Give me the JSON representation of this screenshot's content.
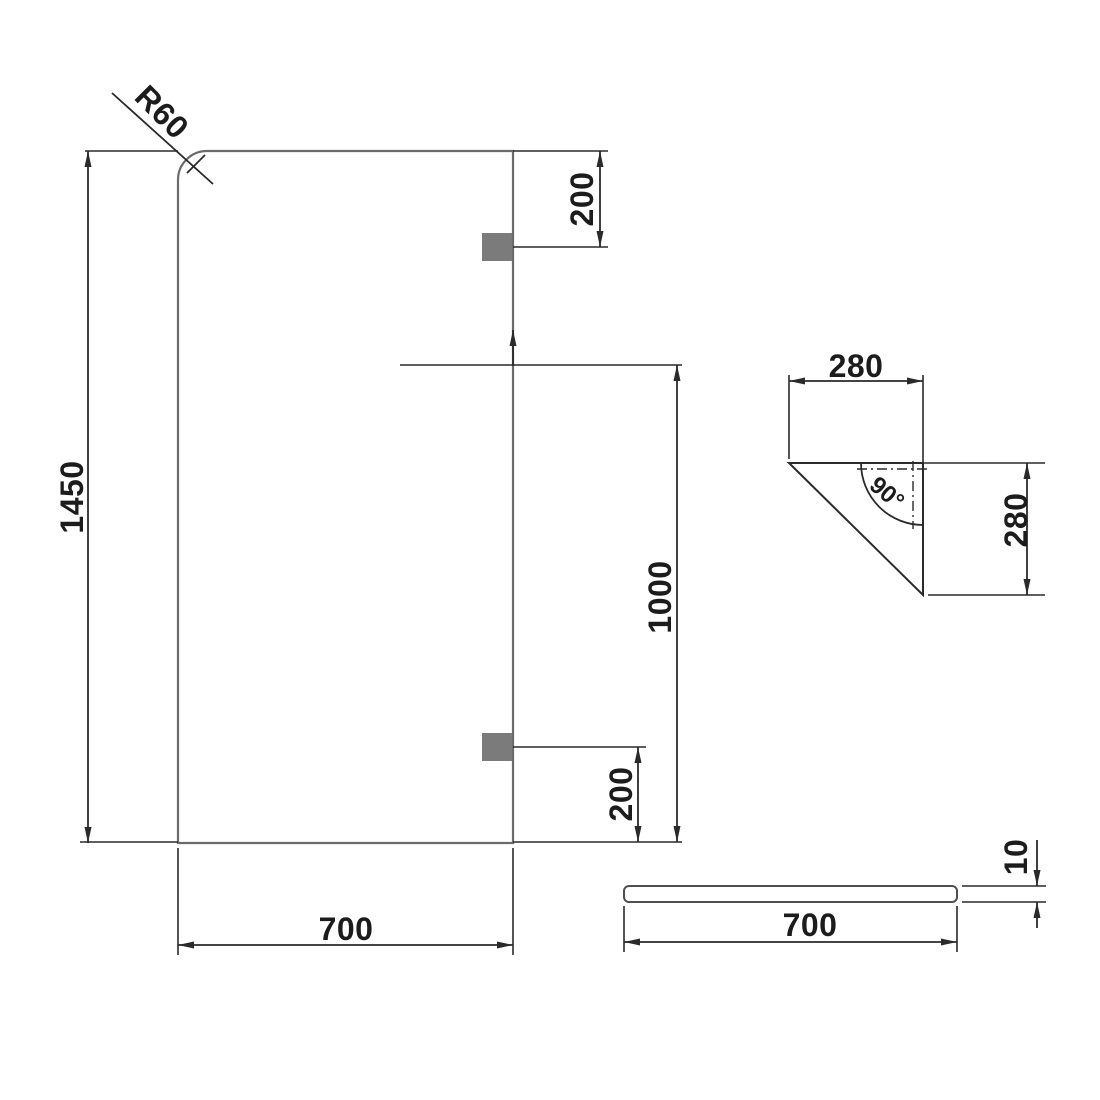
{
  "drawing": {
    "front_view": {
      "height": "1450",
      "width": "700",
      "corner_radius": "R60",
      "top_bracket_offset": "200",
      "bracket_span": "1000",
      "bottom_bracket_offset": "200"
    },
    "corner_bracket_detail": {
      "width": "280",
      "height": "280",
      "angle": "90°"
    },
    "side_profile": {
      "length": "700",
      "thickness": "10"
    },
    "colors": {
      "background": "#ffffff",
      "dimension_line": "#2a2a2a",
      "panel_edge": "#6b6b6b",
      "bracket_fill": "#7b7b7b"
    }
  }
}
